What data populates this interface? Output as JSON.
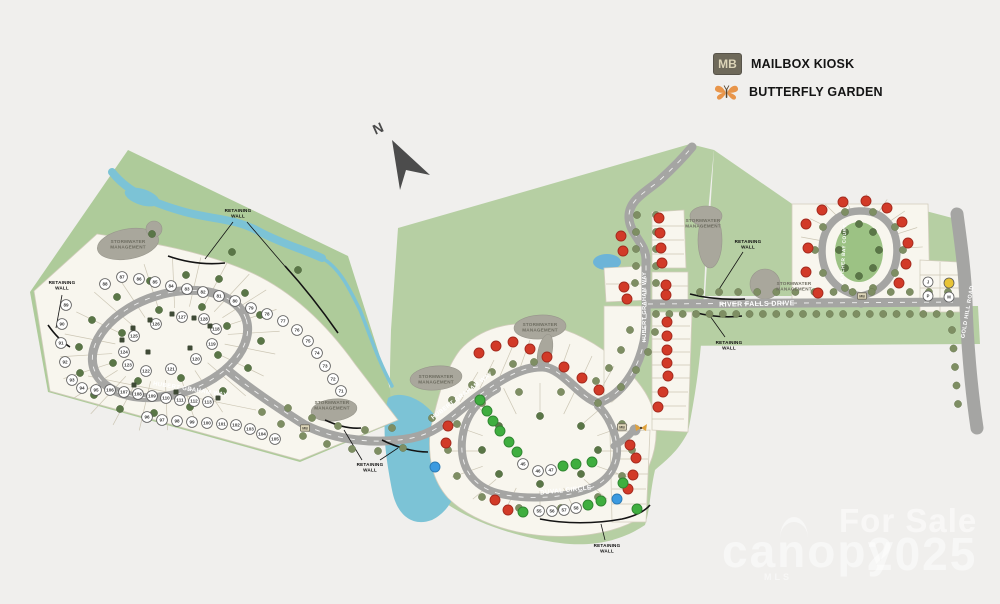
{
  "legend": {
    "mb_abbr": "MB",
    "mailbox_label": "MAILBOX KIOSK",
    "butterfly_label": "BUTTERFLY GARDEN"
  },
  "compass": {
    "label": "N"
  },
  "watermark": {
    "line1": "For Sale",
    "brand": "canopy",
    "brand_sub": "MLS",
    "year": "2025"
  },
  "colors": {
    "sold": "#d23a28",
    "sold_stroke": "#a32a1e",
    "available": "#3fae3f",
    "available_stroke": "#2f8530",
    "pending": "#3b9ae0",
    "pending_stroke": "#2a7ab5",
    "highlight": "#e8c437",
    "road": "#a5a5a3",
    "land": "#b3cc9e",
    "water": "#7cc3d6",
    "lot": "#f8f6ee",
    "tree": "#7e8e63",
    "tree_dark": "#5a7647",
    "blob": "#a9a79c",
    "wall": "#141414"
  },
  "map": {
    "road_labels": [
      {
        "t": "HUBERT GRAHAM WAY",
        "x": 190,
        "y": 391,
        "r": 9,
        "s": 6
      },
      {
        "t": "HUBERT GRAHAM WAY",
        "x": 463,
        "y": 397,
        "r": -37,
        "s": 6
      },
      {
        "t": "HUBERT GRAHAM WAY",
        "x": 646,
        "y": 307,
        "r": -90,
        "s": 5.6
      },
      {
        "t": "DUVAL CIRCLE",
        "x": 566,
        "y": 492,
        "r": -6,
        "s": 6.4
      },
      {
        "t": "RIVER FALLS DRIVE",
        "x": 757,
        "y": 306,
        "r": -1,
        "s": 7
      },
      {
        "t": "CATCHER BAY COURT",
        "x": 845,
        "y": 254,
        "r": -87,
        "s": 4.8
      },
      {
        "t": "GOLD HILL ROAD",
        "x": 969,
        "y": 312,
        "r": -80,
        "s": 5.6
      }
    ],
    "stormwater_label": [
      "STORMWATER",
      "MANAGEMENT"
    ],
    "stormwater_sites": [
      [
        128,
        243
      ],
      [
        332,
        404
      ],
      [
        436,
        378
      ],
      [
        540,
        326
      ],
      [
        703,
        222
      ],
      [
        794,
        285
      ]
    ],
    "retaining_label": [
      "RETAINING",
      "WALL"
    ],
    "retaining_sites": [
      {
        "x": 62,
        "y": 284,
        "leaders": [
          "M62,295 L56,328"
        ],
        "walls": [
          "M48,325 C55,335 62,342 70,347"
        ]
      },
      {
        "x": 238,
        "y": 212,
        "leaders": [
          "M233,222 L205,259",
          "M247,222 L289,271"
        ],
        "walls": [
          "M168,256 C185,262 205,265 225,263",
          "M285,266 C305,288 322,310 338,333"
        ]
      },
      {
        "x": 370,
        "y": 466,
        "leaders": [
          "M362,460 L344,430",
          "M380,460 L398,448"
        ],
        "walls": [
          "M325,420 C338,426 350,429 361,428",
          "M382,440 C398,448 415,452 428,452"
        ]
      },
      {
        "x": 607,
        "y": 547,
        "leaders": [
          "M605,540 L601,524"
        ],
        "walls": [
          "M540,519 C565,524 595,524 622,519 C635,516 645,511 650,505"
        ]
      },
      {
        "x": 748,
        "y": 243,
        "leaders": [
          "M743,252 L716,294"
        ],
        "walls": [
          "M690,294 C705,298 725,300 745,299"
        ]
      },
      {
        "x": 729,
        "y": 344,
        "leaders": [
          "M725,337 L710,316"
        ],
        "walls": [
          "M693,312 C708,316 725,318 742,316"
        ]
      }
    ],
    "lots_sold": [
      [
        479,
        353
      ],
      [
        496,
        346
      ],
      [
        513,
        342
      ],
      [
        530,
        349
      ],
      [
        547,
        357
      ],
      [
        564,
        367
      ],
      [
        582,
        378
      ],
      [
        599,
        390
      ],
      [
        621,
        236
      ],
      [
        623,
        251
      ],
      [
        624,
        287
      ],
      [
        627,
        299
      ],
      [
        659,
        218
      ],
      [
        660,
        233
      ],
      [
        661,
        248
      ],
      [
        662,
        263
      ],
      [
        666,
        285
      ],
      [
        666,
        295
      ],
      [
        667,
        322
      ],
      [
        667,
        336
      ],
      [
        667,
        350
      ],
      [
        667,
        363
      ],
      [
        668,
        376
      ],
      [
        663,
        392
      ],
      [
        658,
        407
      ],
      [
        448,
        426
      ],
      [
        446,
        443
      ],
      [
        630,
        445
      ],
      [
        636,
        458
      ],
      [
        633,
        475
      ],
      [
        628,
        489
      ],
      [
        495,
        500
      ],
      [
        508,
        510
      ],
      [
        806,
        224
      ],
      [
        822,
        210
      ],
      [
        843,
        202
      ],
      [
        866,
        201
      ],
      [
        887,
        208
      ],
      [
        902,
        222
      ],
      [
        908,
        243
      ],
      [
        906,
        264
      ],
      [
        899,
        283
      ],
      [
        808,
        248
      ],
      [
        806,
        272
      ],
      [
        818,
        293
      ]
    ],
    "lots_available": [
      [
        480,
        400
      ],
      [
        487,
        411
      ],
      [
        493,
        421
      ],
      [
        500,
        431
      ],
      [
        509,
        442
      ],
      [
        517,
        452
      ],
      [
        563,
        466
      ],
      [
        576,
        464
      ],
      [
        592,
        462
      ],
      [
        588,
        505
      ],
      [
        601,
        501
      ],
      [
        523,
        512
      ],
      [
        623,
        483
      ],
      [
        637,
        509
      ]
    ],
    "lots_pending": [
      [
        435,
        467
      ],
      [
        617,
        499
      ]
    ],
    "numbered_lots": [
      {
        "n": "88",
        "x": 105,
        "y": 284
      },
      {
        "n": "87",
        "x": 122,
        "y": 277
      },
      {
        "n": "86",
        "x": 139,
        "y": 279
      },
      {
        "n": "85",
        "x": 155,
        "y": 282
      },
      {
        "n": "84",
        "x": 171,
        "y": 286
      },
      {
        "n": "83",
        "x": 187,
        "y": 289
      },
      {
        "n": "82",
        "x": 203,
        "y": 292
      },
      {
        "n": "81",
        "x": 219,
        "y": 296
      },
      {
        "n": "80",
        "x": 235,
        "y": 301
      },
      {
        "n": "79",
        "x": 251,
        "y": 308
      },
      {
        "n": "78",
        "x": 267,
        "y": 314
      },
      {
        "n": "77",
        "x": 283,
        "y": 321
      },
      {
        "n": "76",
        "x": 297,
        "y": 330
      },
      {
        "n": "75",
        "x": 308,
        "y": 341
      },
      {
        "n": "74",
        "x": 317,
        "y": 353
      },
      {
        "n": "73",
        "x": 325,
        "y": 366
      },
      {
        "n": "72",
        "x": 333,
        "y": 379
      },
      {
        "n": "71",
        "x": 341,
        "y": 391
      },
      {
        "n": "89",
        "x": 66,
        "y": 305
      },
      {
        "n": "90",
        "x": 62,
        "y": 324
      },
      {
        "n": "91",
        "x": 61,
        "y": 343
      },
      {
        "n": "92",
        "x": 65,
        "y": 362
      },
      {
        "n": "93",
        "x": 72,
        "y": 380
      },
      {
        "n": "94",
        "x": 82,
        "y": 388
      },
      {
        "n": "95",
        "x": 96,
        "y": 390
      },
      {
        "n": "106",
        "x": 110,
        "y": 390
      },
      {
        "n": "107",
        "x": 124,
        "y": 392
      },
      {
        "n": "108",
        "x": 138,
        "y": 394
      },
      {
        "n": "109",
        "x": 152,
        "y": 396
      },
      {
        "n": "110",
        "x": 166,
        "y": 398
      },
      {
        "n": "111",
        "x": 180,
        "y": 400
      },
      {
        "n": "112",
        "x": 194,
        "y": 401
      },
      {
        "n": "113",
        "x": 208,
        "y": 402
      },
      {
        "n": "96",
        "x": 147,
        "y": 417
      },
      {
        "n": "97",
        "x": 162,
        "y": 420
      },
      {
        "n": "98",
        "x": 177,
        "y": 421
      },
      {
        "n": "99",
        "x": 192,
        "y": 422
      },
      {
        "n": "100",
        "x": 207,
        "y": 423
      },
      {
        "n": "101",
        "x": 222,
        "y": 424
      },
      {
        "n": "102",
        "x": 236,
        "y": 425
      },
      {
        "n": "103",
        "x": 250,
        "y": 429
      },
      {
        "n": "104",
        "x": 262,
        "y": 434
      },
      {
        "n": "105",
        "x": 275,
        "y": 439
      },
      {
        "n": "118",
        "x": 216,
        "y": 329
      },
      {
        "n": "119",
        "x": 212,
        "y": 344
      },
      {
        "n": "120",
        "x": 196,
        "y": 359
      },
      {
        "n": "121",
        "x": 171,
        "y": 369
      },
      {
        "n": "122",
        "x": 146,
        "y": 371
      },
      {
        "n": "123",
        "x": 128,
        "y": 365
      },
      {
        "n": "124",
        "x": 124,
        "y": 352
      },
      {
        "n": "125",
        "x": 134,
        "y": 336
      },
      {
        "n": "126",
        "x": 156,
        "y": 324
      },
      {
        "n": "127",
        "x": 182,
        "y": 317
      },
      {
        "n": "128",
        "x": 204,
        "y": 319
      },
      {
        "n": "45",
        "x": 523,
        "y": 464
      },
      {
        "n": "46",
        "x": 538,
        "y": 471
      },
      {
        "n": "47",
        "x": 551,
        "y": 470
      },
      {
        "n": "55",
        "x": 539,
        "y": 511
      },
      {
        "n": "56",
        "x": 552,
        "y": 511
      },
      {
        "n": "57",
        "x": 564,
        "y": 510
      },
      {
        "n": "58",
        "x": 576,
        "y": 508
      }
    ],
    "building_markers": [
      [
        122,
        340
      ],
      [
        133,
        328
      ],
      [
        150,
        320
      ],
      [
        172,
        314
      ],
      [
        194,
        318
      ],
      [
        210,
        326
      ],
      [
        148,
        352
      ],
      [
        190,
        348
      ],
      [
        134,
        385
      ],
      [
        176,
        392
      ],
      [
        218,
        398
      ]
    ],
    "utility_markers": [
      {
        "t": "J",
        "x": 928,
        "y": 282,
        "fill": "#ffffff"
      },
      {
        "t": "P",
        "x": 928,
        "y": 296,
        "fill": "#ffffff"
      },
      {
        "t": "",
        "x": 949,
        "y": 283,
        "fill": "#e8c437"
      },
      {
        "t": "M",
        "x": 949,
        "y": 297,
        "fill": "#ffffff"
      }
    ],
    "mailbox_markers": [
      [
        305,
        428
      ],
      [
        622,
        427
      ],
      [
        862,
        296
      ]
    ],
    "butterfly_markers": [
      [
        641,
        428
      ]
    ],
    "tree_rows": [
      {
        "x1": 656,
        "y1": 314,
        "x2": 950,
        "y2": 314,
        "n": 23
      },
      {
        "x1": 700,
        "y1": 292,
        "x2": 948,
        "y2": 292,
        "n": 14
      },
      {
        "x1": 952,
        "y1": 330,
        "x2": 958,
        "y2": 404,
        "n": 5
      }
    ],
    "trees": [
      [
        632,
        450
      ],
      [
        622,
        476
      ],
      [
        598,
        497
      ],
      [
        561,
        508
      ],
      [
        519,
        508
      ],
      [
        482,
        497
      ],
      [
        457,
        476
      ],
      [
        448,
        450
      ],
      [
        457,
        424
      ],
      [
        482,
        403
      ],
      [
        519,
        392
      ],
      [
        561,
        392
      ],
      [
        598,
        403
      ],
      [
        622,
        424
      ],
      [
        903,
        250
      ],
      [
        895,
        273
      ],
      [
        873,
        288
      ],
      [
        845,
        288
      ],
      [
        823,
        273
      ],
      [
        815,
        250
      ],
      [
        823,
        227
      ],
      [
        845,
        212
      ],
      [
        873,
        212
      ],
      [
        895,
        227
      ],
      [
        262,
        412
      ],
      [
        281,
        424
      ],
      [
        303,
        436
      ],
      [
        327,
        444
      ],
      [
        352,
        449
      ],
      [
        378,
        451
      ],
      [
        403,
        448
      ],
      [
        288,
        408
      ],
      [
        312,
        418
      ],
      [
        338,
        426
      ],
      [
        365,
        430
      ],
      [
        392,
        428
      ],
      [
        432,
        418
      ],
      [
        452,
        400
      ],
      [
        472,
        385
      ],
      [
        492,
        372
      ],
      [
        513,
        364
      ],
      [
        534,
        362
      ],
      [
        637,
        215
      ],
      [
        636,
        232
      ],
      [
        636,
        249
      ],
      [
        636,
        266
      ],
      [
        635,
        283
      ],
      [
        656,
        215
      ],
      [
        656,
        232
      ],
      [
        656,
        249
      ],
      [
        656,
        266
      ],
      [
        656,
        283
      ],
      [
        630,
        330
      ],
      [
        621,
        350
      ],
      [
        609,
        368
      ],
      [
        596,
        381
      ],
      [
        655,
        332
      ],
      [
        648,
        352
      ],
      [
        636,
        370
      ],
      [
        621,
        387
      ]
    ],
    "trees_dark": [
      [
        260,
        315
      ],
      [
        261,
        341
      ],
      [
        248,
        368
      ],
      [
        223,
        391
      ],
      [
        190,
        407
      ],
      [
        154,
        413
      ],
      [
        120,
        409
      ],
      [
        94,
        395
      ],
      [
        80,
        373
      ],
      [
        79,
        347
      ],
      [
        92,
        320
      ],
      [
        117,
        297
      ],
      [
        150,
        281
      ],
      [
        186,
        275
      ],
      [
        219,
        279
      ],
      [
        245,
        293
      ],
      [
        227,
        326
      ],
      [
        218,
        355
      ],
      [
        181,
        378
      ],
      [
        138,
        381
      ],
      [
        113,
        363
      ],
      [
        122,
        333
      ],
      [
        159,
        310
      ],
      [
        202,
        307
      ],
      [
        598,
        450
      ],
      [
        581,
        474
      ],
      [
        540,
        484
      ],
      [
        499,
        474
      ],
      [
        482,
        450
      ],
      [
        499,
        426
      ],
      [
        540,
        416
      ],
      [
        581,
        426
      ],
      [
        879,
        250
      ],
      [
        873,
        268
      ],
      [
        859,
        276
      ],
      [
        845,
        268
      ],
      [
        839,
        250
      ],
      [
        845,
        232
      ],
      [
        859,
        224
      ],
      [
        873,
        232
      ],
      [
        152,
        234
      ],
      [
        232,
        252
      ],
      [
        298,
        270
      ]
    ]
  }
}
